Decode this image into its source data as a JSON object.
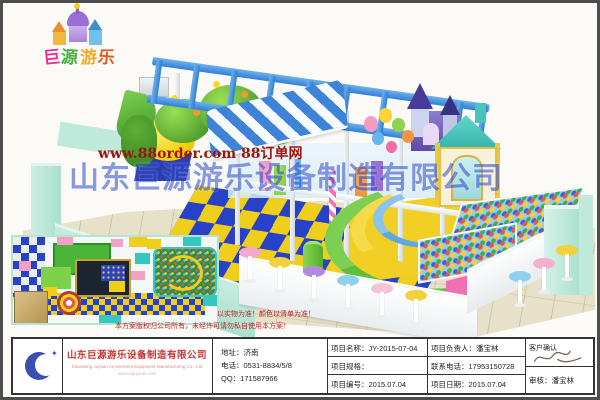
{
  "palette": {
    "wall_mint": "#b3e6d6",
    "checker_blue": "#2742c8",
    "checker_yellow": "#f0cf1c",
    "frame_blue": "#2f7fd6",
    "awning_blue": "#3f83d9",
    "dome_yellow": "#f4cd05",
    "watermark_red": "#9b1508",
    "watermark_blue": "#2b4bd0",
    "disclaimer_red": "#c22222",
    "company_red": "#cc3333",
    "logo_blue": "#3a4fb0"
  },
  "brand": {
    "chars": [
      "巨",
      "源",
      "游",
      "乐"
    ]
  },
  "watermark": {
    "site": "www.88order.com 88订单网",
    "company": "山东巨源游乐设备制造有限公司"
  },
  "disclaimer": {
    "line1": "以实物为准！颜色以清单为准！",
    "line2": "本方案版权归公司所有，未经许可请勿私自使用本方案！"
  },
  "title_block": {
    "company_cn": "山东巨源游乐设备制造有限公司",
    "company_en": "Shandong Juyuan Amusement Equipment Manufacturing Co., Ltd",
    "company_site": "www.sdjuyuan.com",
    "address": "地址：济南",
    "phone": "电话：0531-8834/5/8",
    "qq": "QQ：171587966",
    "project_name": "项目名称：JY-2015-07-04",
    "project_leader": "项目负责人：潘宝林",
    "project_spec": "项目规格：",
    "contact_phone": "联系电话：17953150728",
    "project_no": "项目编号：2015.07.04",
    "project_date": "项目日期：2015.07.04",
    "customer_confirm": "客户确认",
    "review": "审核：潘宝林"
  }
}
